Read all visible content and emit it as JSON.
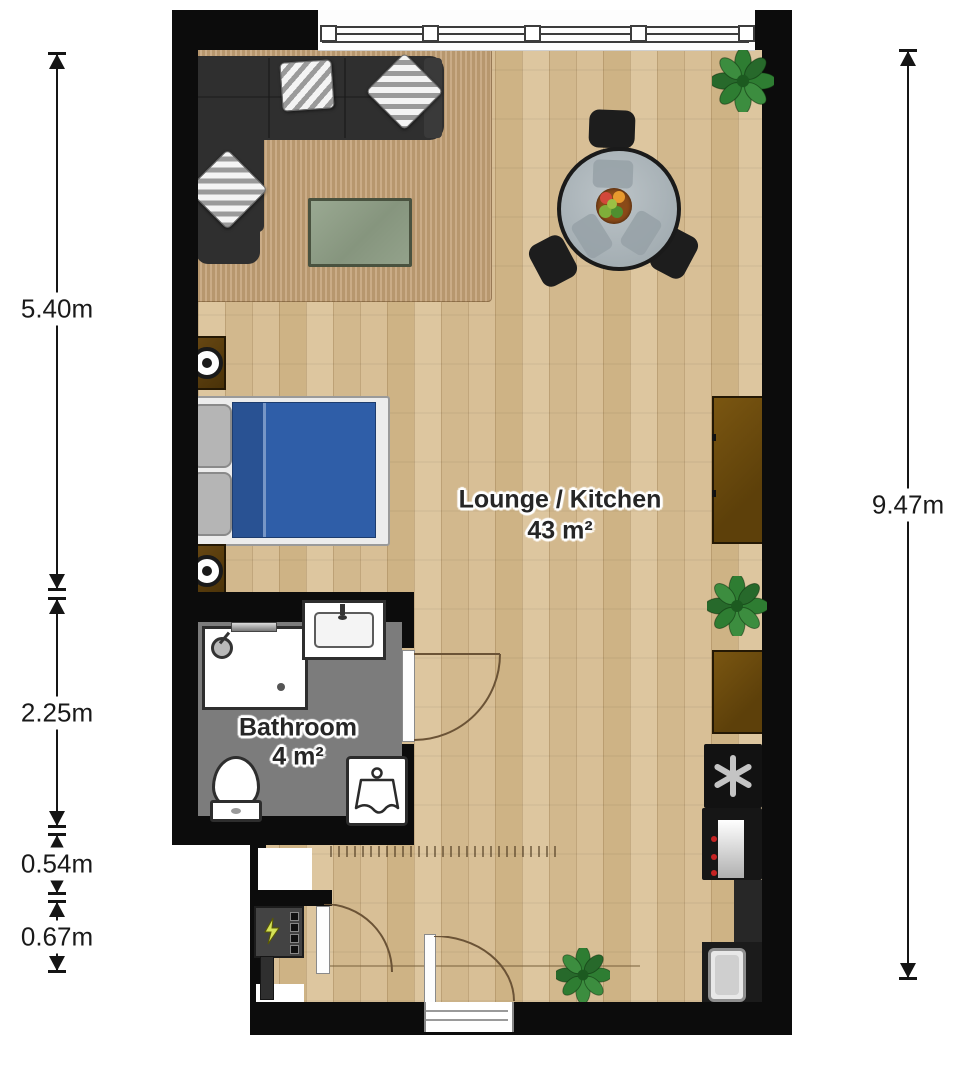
{
  "title": "Studio apartment floor plan",
  "rooms": {
    "lounge": {
      "name": "Lounge / Kitchen",
      "area": "43 m²"
    },
    "bathroom": {
      "name": "Bathroom",
      "area": "4 m²"
    }
  },
  "dims": {
    "left": [
      {
        "label": "5.40m"
      },
      {
        "label": "2.25m"
      },
      {
        "label": "0.54m"
      },
      {
        "label": "0.67m"
      }
    ],
    "right": [
      {
        "label": "9.47m"
      }
    ]
  },
  "furniture_icons": [
    "corner-sofa-icon",
    "striped-pillow-icon",
    "rug-icon",
    "coffee-table-icon",
    "dining-table-icon",
    "dining-chair-icon",
    "fruit-bowl-icon",
    "plant-icon",
    "double-bed-icon",
    "nightstand-lamp-icon",
    "sideboard-icon",
    "freezer-asterisk-icon",
    "oven-icon",
    "kitchen-counter-icon",
    "kitchen-sink-icon",
    "shower-icon",
    "washbasin-icon",
    "toilet-icon",
    "washing-machine-icon",
    "electrical-panel-icon",
    "door-swing-arc-icon",
    "window-icon"
  ],
  "colors": {
    "wall": "#0c0c0c",
    "floor_wood": "#d9c198",
    "rug": "#c2a075",
    "bathroom_floor": "#7c7c7c",
    "duvet_blue": "#2f5ea8",
    "cabinet_brown": "#6b4a0e",
    "plant_green": "#2e7d32",
    "table_gray": "#b2bac0",
    "sofa_charcoal": "#2f2f2f",
    "coffee_table_green": "#93a18a"
  }
}
